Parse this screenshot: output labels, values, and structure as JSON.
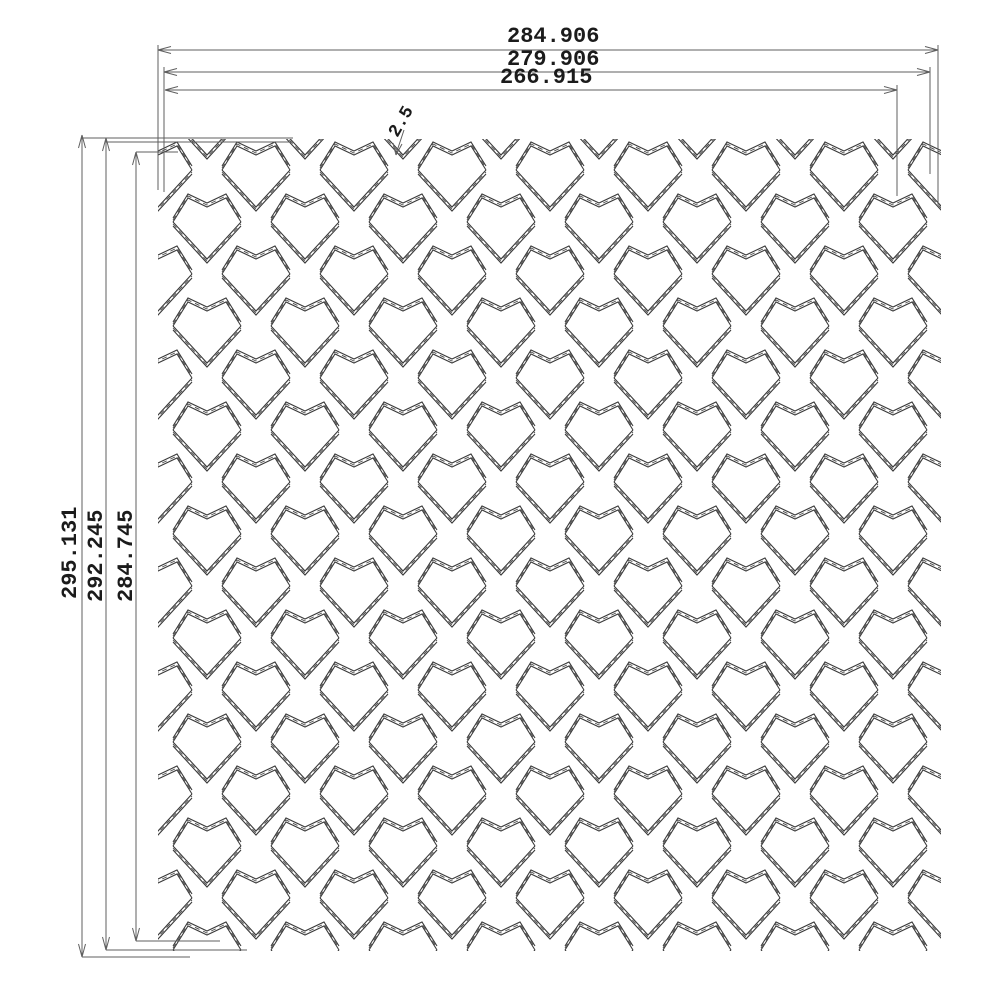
{
  "drawing": {
    "background": "#ffffff",
    "mesh_line_color": "#3a3a3a",
    "mesh_dash_color": "#4a4a4a",
    "dim_line_color": "#5f5f5f",
    "text_color": "#1b1b1b"
  },
  "dimensions": {
    "top": [
      {
        "label": "284.906"
      },
      {
        "label": "279.906"
      },
      {
        "label": "266.915"
      }
    ],
    "left": [
      {
        "label": "295.131"
      },
      {
        "label": "292.245"
      },
      {
        "label": "284.745"
      }
    ],
    "strand_width": {
      "label": "2.5"
    }
  }
}
